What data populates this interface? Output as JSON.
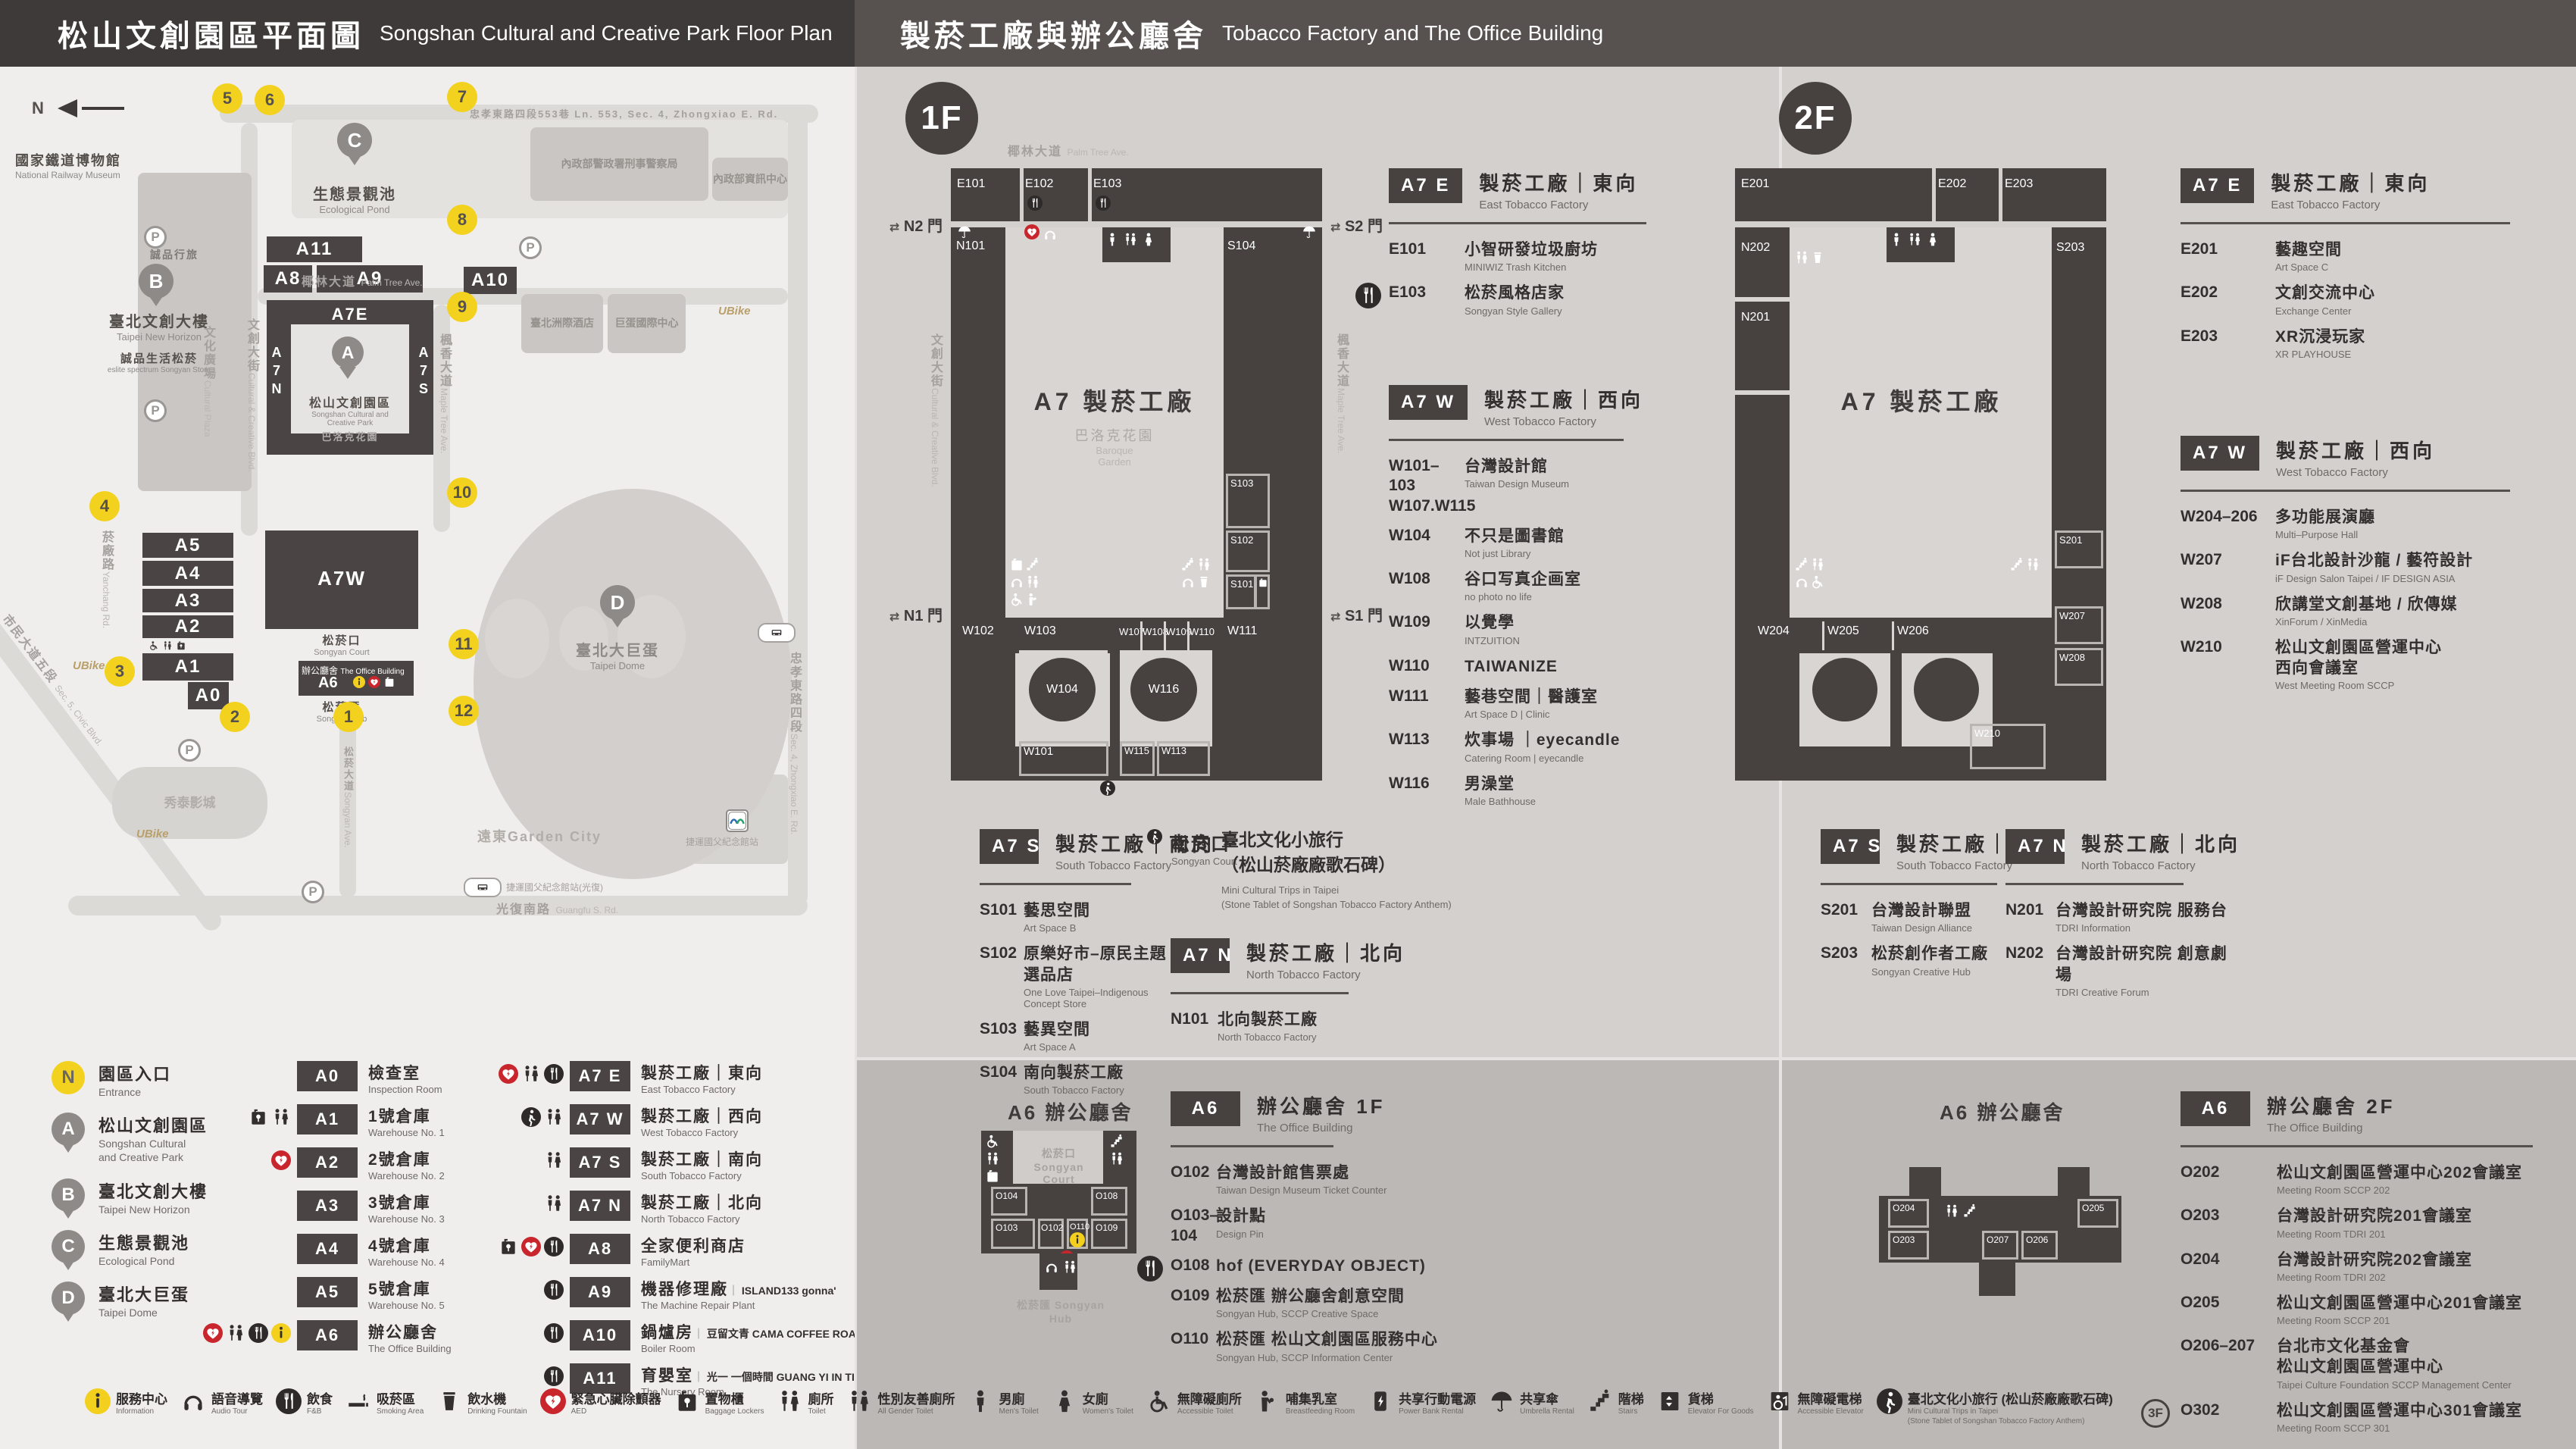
{
  "headers": {
    "left": {
      "zh": "松山文創園區平面圖",
      "en": "Songshan Cultural and Creative Park Floor Plan"
    },
    "right": {
      "zh": "製菸工廠與辦公廳舍",
      "en": "Tobacco Factory and The Office Building"
    }
  },
  "map": {
    "north": "N",
    "entrances": [
      "1",
      "2",
      "3",
      "4",
      "5",
      "6",
      "7",
      "8",
      "9",
      "10",
      "11",
      "12"
    ],
    "pins": {
      "a": "A",
      "b": "B",
      "c": "C",
      "d": "D"
    },
    "parking": "P",
    "blocks": {
      "a11": "A11",
      "a8": "A8",
      "a9": "A9",
      "a5": "A5",
      "a4": "A4",
      "a3": "A3",
      "a2": "A2",
      "a1": "A1",
      "a0": "A0",
      "a10": "A10",
      "a7e": "A7E",
      "a7w": "A7W",
      "a6": "A6",
      "a7n": "A7N",
      "a7s": "A7S"
    },
    "labels": {
      "railway": {
        "zh": "國家鐵道博物館",
        "en": "National Railway Museum"
      },
      "eslite_hotel": "誠品行旅",
      "new_horizon": {
        "zh": "臺北文創大樓",
        "en": "Taipei New Horizon"
      },
      "eslite_spectrum": {
        "zh": "誠品生活松菸",
        "en": "eslite spectrum Songyan Store"
      },
      "cultural_plaza": {
        "zh": "文化廣場",
        "en": "Cultural Plaza"
      },
      "cc_blvd": {
        "zh": "文創大街",
        "en": "Cultural & Creative Blvd."
      },
      "pond": {
        "zh": "生態景觀池",
        "en": "Ecological Pond"
      },
      "palm": {
        "zh": "椰林大道",
        "en": "Palm Tree Ave."
      },
      "park": {
        "zh": "松山文創園區",
        "en": "Songshan Cultural and\nCreative Park"
      },
      "baroque": {
        "zh": "巴洛克花園",
        "en": "Baroque Garden"
      },
      "maple": {
        "zh": "楓香大道",
        "en": "Maple Tree Ave."
      },
      "yanchang": {
        "zh": "菸廠路",
        "en": "Yanchang Rd."
      },
      "civic": {
        "zh": "市民大道五段",
        "en": "Sec. 5, Civic Blvd."
      },
      "dome": {
        "zh": "臺北大巨蛋",
        "en": "Taipei Dome"
      },
      "intercontinental": "臺北洲際酒店",
      "dome_center": "巨蛋國際中心",
      "cib": "內政部警政署刑事警察局",
      "moi_info": "內政部資訊中心",
      "zx_lane": "忠孝東路四段553巷 Ln. 553, Sec. 4, Zhongxiao E. Rd.",
      "zhongxiao": {
        "zh": "忠孝東路四段",
        "en": "Sec. 4, Zhongxiao E. Rd."
      },
      "guangfu": {
        "zh": "光復南路",
        "en": "Guangfu S. Rd."
      },
      "songyan_ave": {
        "zh": "松菸大道",
        "en": "Songyan Ave."
      },
      "songyan_court": {
        "zh": "松菸口",
        "en": "Songyan Court"
      },
      "office": {
        "zh": "辦公廳舍",
        "en": "The Office Building"
      },
      "songyan_hub": {
        "zh": "松菸匯",
        "en": "Songyan Hub"
      },
      "showtime": "秀泰影城",
      "garden_city": "遠東Garden City",
      "mrt": "捷運國父紀念館站",
      "mrt_exit": "捷運國父紀念館站(光復)",
      "ubike": "UBike"
    }
  },
  "legend": {
    "places": [
      {
        "badge": "N",
        "cls": "badge-n",
        "zh": "園區入口",
        "en": "Entrance"
      },
      {
        "badge": "A",
        "cls": "badge-pin",
        "zh": "松山文創園區",
        "en": "Songshan Cultural\nand Creative Park"
      },
      {
        "badge": "B",
        "cls": "badge-pin",
        "zh": "臺北文創大樓",
        "en": "Taipei New Horizon"
      },
      {
        "badge": "C",
        "cls": "badge-pin",
        "zh": "生態景觀池",
        "en": "Ecological Pond"
      },
      {
        "badge": "D",
        "cls": "badge-pin",
        "zh": "臺北大巨蛋",
        "en": "Taipei Dome"
      }
    ],
    "col2": [
      {
        "code": "A0",
        "zh": "檢查室",
        "en": "Inspection Room",
        "icons": []
      },
      {
        "code": "A1",
        "zh": "1號倉庫",
        "en": "Warehouse No. 1",
        "icons": [
          "locker",
          "toilet"
        ]
      },
      {
        "code": "A2",
        "zh": "2號倉庫",
        "en": "Warehouse No. 2",
        "icons": [
          "aed"
        ]
      },
      {
        "code": "A3",
        "zh": "3號倉庫",
        "en": "Warehouse No. 3",
        "icons": []
      },
      {
        "code": "A4",
        "zh": "4號倉庫",
        "en": "Warehouse No. 4",
        "icons": []
      },
      {
        "code": "A5",
        "zh": "5號倉庫",
        "en": "Warehouse No. 5",
        "icons": []
      },
      {
        "code": "A6",
        "zh": "辦公廳舍",
        "en": "The Office Building",
        "icons": [
          "aed",
          "toilet",
          "fnb",
          "info"
        ]
      }
    ],
    "col3": [
      {
        "code": "A7 E",
        "zh": "製菸工廠｜東向",
        "en": "East Tobacco Factory",
        "icons": [
          "aed",
          "toilet",
          "fnb"
        ]
      },
      {
        "code": "A7 W",
        "zh": "製菸工廠｜西向",
        "en": "West Tobacco Factory",
        "icons": [
          "walkc",
          "toilet"
        ]
      },
      {
        "code": "A7 S",
        "zh": "製菸工廠｜南向",
        "en": "South Tobacco Factory",
        "icons": [
          "toilet"
        ]
      },
      {
        "code": "A7 N",
        "zh": "製菸工廠｜北向",
        "en": "North Tobacco Factory",
        "icons": [
          "toilet"
        ]
      },
      {
        "code": "A8",
        "zh": "全家便利商店",
        "en": "FamilyMart",
        "icons": [
          "locker",
          "aed",
          "fnb"
        ]
      },
      {
        "code": "A9",
        "zh": "機器修理廠",
        "en": "The Machine Repair Plant",
        "partner": "ISLAND133 gonna'",
        "icons": [
          "fnb"
        ]
      },
      {
        "code": "A10",
        "zh": "鍋爐房",
        "en": "Boiler Room",
        "partner": "豆留文青 CAMA COFFEE ROASTERS",
        "icons": [
          "fnb"
        ]
      },
      {
        "code": "A11",
        "zh": "育嬰室",
        "en": "The Nursery Room",
        "partner": "光一 一個時間 GUANG YI IN TIME",
        "icons": [
          "fnb"
        ]
      }
    ]
  },
  "strip": [
    {
      "icon": "info",
      "zh": "服務中心",
      "en": "Information"
    },
    {
      "icon": "audio",
      "zh": "語音導覽",
      "en": "Audio Tour"
    },
    {
      "icon": "fnb",
      "zh": "飲食",
      "en": "F&B"
    },
    {
      "icon": "smoking",
      "zh": "吸菸區",
      "en": "Smoking Area"
    },
    {
      "icon": "fountain",
      "zh": "飲水機",
      "en": "Drinking Fountain"
    },
    {
      "icon": "aed",
      "zh": "緊急心臟除顫器",
      "en": "AED"
    },
    {
      "icon": "locker",
      "zh": "置物櫃",
      "en": "Baggage Lockers"
    },
    {
      "icon": "toilet",
      "zh": "廁所",
      "en": "Toilet"
    },
    {
      "icon": "allgender",
      "zh": "性別友善廁所",
      "en": "All Gender Toilet"
    },
    {
      "icon": "male",
      "zh": "男廁",
      "en": "Men's Toilet"
    },
    {
      "icon": "female",
      "zh": "女廁",
      "en": "Women's Toilet"
    },
    {
      "icon": "wheelchair",
      "zh": "無障礙廁所",
      "en": "Accessible Toilet"
    },
    {
      "icon": "baby",
      "zh": "哺集乳室",
      "en": "Breastfeeding Room"
    },
    {
      "icon": "powerbank",
      "zh": "共享行動電源",
      "en": "Power Bank Rental"
    },
    {
      "icon": "umbrella",
      "zh": "共享傘",
      "en": "Umbrella Rental"
    },
    {
      "icon": "stairs",
      "zh": "階梯",
      "en": "Stairs"
    },
    {
      "icon": "lift",
      "zh": "貨梯",
      "en": "Elevator For Goods"
    },
    {
      "icon": "lift2",
      "zh": "無障礙電梯",
      "en": "Accessible Elevator"
    },
    {
      "icon": "walkc",
      "zh": "臺北文化小旅行 (松山菸廠廠歌石碑)",
      "en": "Mini Cultural Trips in Taipei\n(Stone Tablet of Songshan Tobacco Factory Anthem)"
    }
  ],
  "f1": {
    "badge": "1F",
    "plan": {
      "street_top": {
        "zh": "椰林大道",
        "en": "Palm Tree Ave."
      },
      "street_left": {
        "zh": "文創大街",
        "en": "Cultural & Creative Blvd."
      },
      "street_right": {
        "zh": "楓香大道",
        "en": "Maple Tree Ave."
      },
      "center": "A7 製菸工廠",
      "garden": {
        "zh": "巴洛克花園",
        "en": "Baroque\nGarden"
      },
      "gates": {
        "n2": "N2 門",
        "s2": "S2 門",
        "n1": "N1 門",
        "s1": "S1 門",
        "arrows": "⇄"
      },
      "rooms": {
        "e101": "E101",
        "e102": "E102",
        "e103": "E103",
        "n101": "N101",
        "s104": "S104",
        "s103": "S103",
        "s102": "S102",
        "s101": "S101",
        "w101": "W101",
        "w102": "W102",
        "w103": "W103",
        "w104": "W104",
        "w107": "W107",
        "w108": "W108",
        "w109": "W109",
        "w110": "W110",
        "w111": "W111",
        "w113": "W113",
        "w115": "W115",
        "w116": "W116"
      }
    },
    "a7e": {
      "code": "A7 E",
      "zh": "製菸工廠｜東向",
      "en": "East Tobacco Factory",
      "items": [
        {
          "code": "E101",
          "zh": "小智研發垃圾廚坊",
          "en": "MINIWIZ Trash Kitchen"
        },
        {
          "code": "E103",
          "zh": "松菸風格店家",
          "en": "Songyan Style Gallery",
          "icons": [
            "fnb"
          ]
        }
      ]
    },
    "a7w": {
      "code": "A7 W",
      "zh": "製菸工廠｜西向",
      "en": "West Tobacco Factory",
      "items": [
        {
          "code": "W101–103\nW107.W115",
          "zh": "台灣設計館",
          "en": "Taiwan Design Museum"
        },
        {
          "code": "W104",
          "zh": "不只是圖書館",
          "en": "Not just Library"
        },
        {
          "code": "W108",
          "zh": "谷口写真企画室",
          "en": "no photo no life"
        },
        {
          "code": "W109",
          "zh": "以覺學",
          "en": "INTZUITION"
        },
        {
          "code": "W110",
          "zh": "TAIWANIZE",
          "en": ""
        },
        {
          "code": "W111",
          "zh": "藝巷空間｜醫護室",
          "en": "Art Space D | Clinic"
        },
        {
          "code": "W113",
          "zh": "炊事場 ｜eyecandle",
          "en": "Catering Room | eyecandle"
        },
        {
          "code": "W116",
          "zh": "男澡堂",
          "en": "Male Bathhouse"
        }
      ]
    },
    "a7s": {
      "code": "A7 S",
      "zh": "製菸工廠｜南向",
      "en": "South Tobacco Factory",
      "items": [
        {
          "code": "S101",
          "zh": "藝思空間",
          "en": "Art Space B"
        },
        {
          "code": "S102",
          "zh": "原樂好市–原民主題選品店",
          "en": "One Love Taipei–Indigenous Concept Store"
        },
        {
          "code": "S103",
          "zh": "藝異空間",
          "en": "Art Space A"
        },
        {
          "code": "S104",
          "zh": "南向製菸工廠",
          "en": "South Tobacco Factory"
        }
      ]
    },
    "songyankou": {
      "zh": "松菸口",
      "en": "Songyan Court",
      "name_zh": "臺北文化小旅行\n（松山菸廠廠歌石碑）",
      "name_en": "Mini Cultural Trips in Taipei\n(Stone Tablet of Songshan Tobacco Factory Anthem)"
    },
    "a7n": {
      "code": "A7 N",
      "zh": "製菸工廠｜北向",
      "en": "North Tobacco Factory",
      "items": [
        {
          "code": "N101",
          "zh": "北向製菸工廠",
          "en": "North Tobacco Factory"
        }
      ]
    },
    "a6": {
      "code": "A6",
      "zh": "辦公廳舍 1F",
      "en": "The Office Building",
      "plan_title": "A6 辦公廳舍",
      "court": {
        "zh": "松菸口 Songyan Court"
      },
      "hub": {
        "zh": "松菸匯 Songyan Hub"
      },
      "plan_rooms": {
        "o104": "O104",
        "o103": "O103",
        "o102": "O102",
        "o110": "O110",
        "o109": "O109",
        "o108": "O108"
      },
      "items": [
        {
          "code": "O102",
          "zh": "台灣設計館售票處",
          "en": "Taiwan Design Museum Ticket Counter"
        },
        {
          "code": "O103–104",
          "zh": "設計點",
          "en": "Design Pin"
        },
        {
          "code": "O108",
          "zh": "hof (EVERYDAY OBJECT)",
          "en": "",
          "icons": [
            "fnb"
          ]
        },
        {
          "code": "O109",
          "zh": "松菸匯 辦公廳舍創意空間",
          "en": "Songyan Hub, SCCP Creative Space"
        },
        {
          "code": "O110",
          "zh": "松菸匯 松山文創園區服務中心",
          "en": "Songyan Hub, SCCP Information Center"
        }
      ]
    }
  },
  "f2": {
    "badge": "2F",
    "plan": {
      "center": "A7 製菸工廠",
      "rooms": {
        "e201": "E201",
        "e202": "E202",
        "e203": "E203",
        "n201": "N201",
        "n202": "N202",
        "s201": "S201",
        "s203": "S203",
        "w204": "W204",
        "w205": "W205",
        "w206": "W206",
        "w207": "W207",
        "w208": "W208",
        "w210": "W210"
      }
    },
    "a7e": {
      "code": "A7 E",
      "zh": "製菸工廠｜東向",
      "en": "East Tobacco Factory",
      "items": [
        {
          "code": "E201",
          "zh": "藝趣空間",
          "en": "Art Space C"
        },
        {
          "code": "E202",
          "zh": "文創交流中心",
          "en": "Exchange Center"
        },
        {
          "code": "E203",
          "zh": "XR沉浸玩家",
          "en": "XR PLAYHOUSE"
        }
      ]
    },
    "a7w": {
      "code": "A7 W",
      "zh": "製菸工廠｜西向",
      "en": "West Tobacco Factory",
      "items": [
        {
          "code": "W204–206",
          "zh": "多功能展演廳",
          "en": "Multi–Purpose Hall"
        },
        {
          "code": "W207",
          "zh": "iF台北設計沙龍 / 藝符設計",
          "en": "iF Design Salon Taipei / IF DESIGN ASIA"
        },
        {
          "code": "W208",
          "zh": "欣講堂文創基地 / 欣傳媒",
          "en": "XinForum / XinMedia"
        },
        {
          "code": "W210",
          "zh": "松山文創園區營運中心\n西向會議室",
          "en": "West Meeting Room SCCP"
        }
      ]
    },
    "a7s": {
      "code": "A7 S",
      "zh": "製菸工廠｜南向",
      "en": "South Tobacco Factory",
      "items": [
        {
          "code": "S201",
          "zh": "台灣設計聯盟",
          "en": "Taiwan Design Alliance"
        },
        {
          "code": "S203",
          "zh": "松菸創作者工廠",
          "en": "Songyan Creative Hub"
        }
      ]
    },
    "a7n": {
      "code": "A7 N",
      "zh": "製菸工廠｜北向",
      "en": "North Tobacco Factory",
      "items": [
        {
          "code": "N201",
          "zh": "台灣設計研究院 服務台",
          "en": "TDRI Information"
        },
        {
          "code": "N202",
          "zh": "台灣設計研究院 創意劇場",
          "en": "TDRI Creative Forum"
        }
      ]
    },
    "a6": {
      "code": "A6",
      "zh": "辦公廳舍 2F",
      "en": "The Office Building",
      "plan_title": "A6 辦公廳舍",
      "plan_rooms": {
        "o204": "O204",
        "o205": "O205",
        "o203": "O203",
        "o207": "O207",
        "o206": "O206"
      },
      "items": [
        {
          "code": "O202",
          "zh": "松山文創園區營運中心202會議室",
          "en": "Meeting Room SCCP 202"
        },
        {
          "code": "O203",
          "zh": "台灣設計研究院201會議室",
          "en": "Meeting Room TDRI 201"
        },
        {
          "code": "O204",
          "zh": "台灣設計研究院202會議室",
          "en": "Meeting Room TDRI 202"
        },
        {
          "code": "O205",
          "zh": "松山文創園區營運中心201會議室",
          "en": "Meeting Room SCCP 201"
        },
        {
          "code": "O206–207",
          "zh": "台北市文化基金會\n松山文創園區營運中心",
          "en": "Taipei Culture Foundation SCCP Management Center"
        },
        {
          "code": "O302",
          "badge": "3F",
          "zh": "松山文創園區營運中心301會議室",
          "en": "Meeting Room SCCP 301"
        }
      ]
    }
  },
  "colors": {
    "header_left": "#3e3a39",
    "header_right": "#575150",
    "dark_block": "#474140",
    "yellow": "#f2d21f",
    "red": "#c9252d",
    "band": "#bcb8b5",
    "panel": "#d3d0cd",
    "light_panel": "#efeeec"
  }
}
